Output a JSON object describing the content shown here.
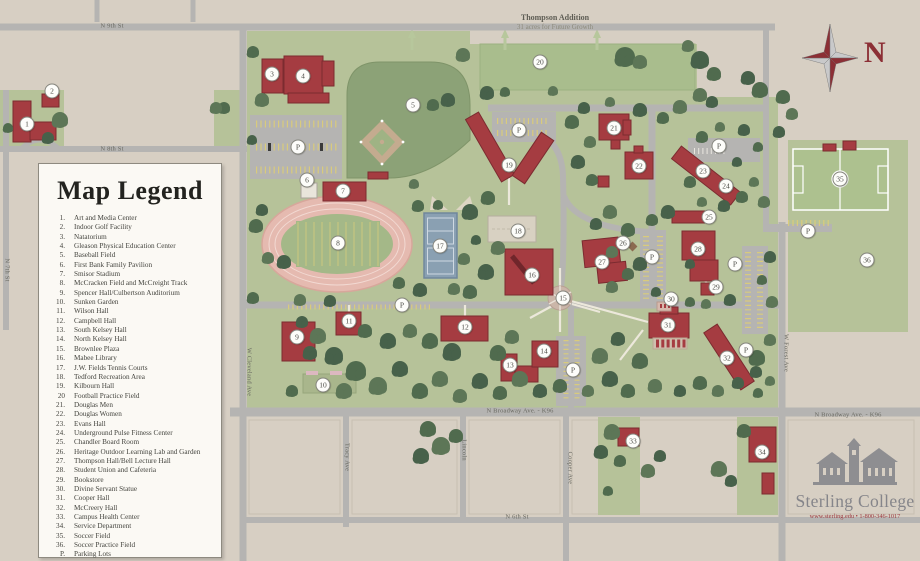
{
  "legend": {
    "title": "Map Legend",
    "items": [
      {
        "num": "1.",
        "label": "Art and Media Center"
      },
      {
        "num": "2.",
        "label": "Indoor Golf Facility"
      },
      {
        "num": "3.",
        "label": "Natatorium"
      },
      {
        "num": "4.",
        "label": "Gleason Physical Education Center"
      },
      {
        "num": "5.",
        "label": "Baseball Field"
      },
      {
        "num": "6.",
        "label": "First Bank Family Pavilion"
      },
      {
        "num": "7.",
        "label": "Smisor Stadium"
      },
      {
        "num": "8.",
        "label": "McCracken Field and McCreight Track"
      },
      {
        "num": "9.",
        "label": "Spencer Hall/Culbertson Auditorium"
      },
      {
        "num": "10.",
        "label": "Sunken Garden"
      },
      {
        "num": "11.",
        "label": "Wilson Hall"
      },
      {
        "num": "12.",
        "label": "Campbell Hall"
      },
      {
        "num": "13.",
        "label": "South Kelsey Hall"
      },
      {
        "num": "14.",
        "label": "North Kelsey Hall"
      },
      {
        "num": "15.",
        "label": "Brownlee Plaza"
      },
      {
        "num": "16.",
        "label": "Mabee Library"
      },
      {
        "num": "17.",
        "label": "J.W. Fields Tennis Courts"
      },
      {
        "num": "18.",
        "label": "Tedford Recreation Area"
      },
      {
        "num": "19.",
        "label": "Kilbourn Hall"
      },
      {
        "num": "20",
        "label": "Football Practice Field"
      },
      {
        "num": "21.",
        "label": "Douglas Men"
      },
      {
        "num": "22.",
        "label": "Douglas Women"
      },
      {
        "num": "23.",
        "label": "Evans Hall"
      },
      {
        "num": "24.",
        "label": "Underground Pulse Fitness Center"
      },
      {
        "num": "25.",
        "label": "Chandler Board Room"
      },
      {
        "num": "26.",
        "label": "Heritage Outdoor Learning Lab and Garden"
      },
      {
        "num": "27.",
        "label": "Thompson Hall/Bell Lecture Hall"
      },
      {
        "num": "28.",
        "label": "Student Union and Cafeteria"
      },
      {
        "num": "29.",
        "label": "Bookstore"
      },
      {
        "num": "30.",
        "label": "Divine Servant Statue"
      },
      {
        "num": "31.",
        "label": "Cooper Hall"
      },
      {
        "num": "32.",
        "label": "McCreery Hall"
      },
      {
        "num": "33.",
        "label": "Campus Health Center"
      },
      {
        "num": "34.",
        "label": "Service Department"
      },
      {
        "num": "35.",
        "label": "Soccer Field"
      },
      {
        "num": "36.",
        "label": "Soccer Practice Field"
      },
      {
        "num": "P.",
        "label": "Parking Lots"
      }
    ]
  },
  "map_labels": {
    "thompson_title": "Thompson Addition",
    "thompson_subtitle": "31 acres for Future Growth"
  },
  "compass": {
    "north_label": "N"
  },
  "logo": {
    "name": "Sterling College",
    "contact": "www.sterling.edu  •  1-800-346-1017"
  },
  "streets": [
    {
      "name": "N 9th St",
      "x": 112,
      "y": 26,
      "rot": 0
    },
    {
      "name": "N 8th St",
      "x": 112,
      "y": 149,
      "rot": 0
    },
    {
      "name": "N 7th St",
      "x": 7,
      "y": 270,
      "rot": 90
    },
    {
      "name": "W Cleveland Ave",
      "x": 249,
      "y": 372,
      "rot": 90
    },
    {
      "name": "Tracy Ave",
      "x": 347,
      "y": 457,
      "rot": 90
    },
    {
      "name": "Lincoln",
      "x": 464,
      "y": 450,
      "rot": 90
    },
    {
      "name": "Cooper Ave",
      "x": 570,
      "y": 468,
      "rot": 90
    },
    {
      "name": "W Forest Ave",
      "x": 786,
      "y": 353,
      "rot": 90
    },
    {
      "name": "N Broadway Ave. - K96",
      "x": 520,
      "y": 411,
      "rot": 0
    },
    {
      "name": "N Broadway Ave. - K96",
      "x": 848,
      "y": 415,
      "rot": 0
    },
    {
      "name": "N 6th St",
      "x": 517,
      "y": 517,
      "rot": 0
    }
  ],
  "markers": {
    "parking_label": "P",
    "buildings": [
      {
        "n": "1",
        "x": 27,
        "y": 124
      },
      {
        "n": "2",
        "x": 52,
        "y": 91
      },
      {
        "n": "3",
        "x": 272,
        "y": 74
      },
      {
        "n": "4",
        "x": 303,
        "y": 76
      },
      {
        "n": "5",
        "x": 413,
        "y": 105
      },
      {
        "n": "6",
        "x": 307,
        "y": 180
      },
      {
        "n": "7",
        "x": 343,
        "y": 191
      },
      {
        "n": "8",
        "x": 338,
        "y": 243
      },
      {
        "n": "9",
        "x": 297,
        "y": 337
      },
      {
        "n": "10",
        "x": 323,
        "y": 385
      },
      {
        "n": "11",
        "x": 349,
        "y": 321
      },
      {
        "n": "12",
        "x": 465,
        "y": 327
      },
      {
        "n": "13",
        "x": 510,
        "y": 365
      },
      {
        "n": "14",
        "x": 544,
        "y": 351
      },
      {
        "n": "15",
        "x": 563,
        "y": 298
      },
      {
        "n": "16",
        "x": 532,
        "y": 275
      },
      {
        "n": "17",
        "x": 440,
        "y": 246
      },
      {
        "n": "18",
        "x": 518,
        "y": 231
      },
      {
        "n": "19",
        "x": 509,
        "y": 165
      },
      {
        "n": "20",
        "x": 540,
        "y": 62
      },
      {
        "n": "21",
        "x": 614,
        "y": 128
      },
      {
        "n": "22",
        "x": 639,
        "y": 166
      },
      {
        "n": "23",
        "x": 703,
        "y": 171
      },
      {
        "n": "24",
        "x": 726,
        "y": 186
      },
      {
        "n": "25",
        "x": 709,
        "y": 217
      },
      {
        "n": "26",
        "x": 623,
        "y": 243
      },
      {
        "n": "27",
        "x": 602,
        "y": 262
      },
      {
        "n": "28",
        "x": 698,
        "y": 249
      },
      {
        "n": "29",
        "x": 716,
        "y": 287
      },
      {
        "n": "30",
        "x": 671,
        "y": 299
      },
      {
        "n": "31",
        "x": 668,
        "y": 325
      },
      {
        "n": "32",
        "x": 727,
        "y": 358
      },
      {
        "n": "33",
        "x": 633,
        "y": 441
      },
      {
        "n": "34",
        "x": 762,
        "y": 452
      },
      {
        "n": "35",
        "x": 840,
        "y": 179
      },
      {
        "n": "36",
        "x": 867,
        "y": 260
      }
    ],
    "parking": [
      {
        "x": 298,
        "y": 147
      },
      {
        "x": 402,
        "y": 305
      },
      {
        "x": 519,
        "y": 130
      },
      {
        "x": 573,
        "y": 370
      },
      {
        "x": 652,
        "y": 257
      },
      {
        "x": 719,
        "y": 146
      },
      {
        "x": 735,
        "y": 264
      },
      {
        "x": 746,
        "y": 350
      },
      {
        "x": 808,
        "y": 231
      }
    ]
  }
}
